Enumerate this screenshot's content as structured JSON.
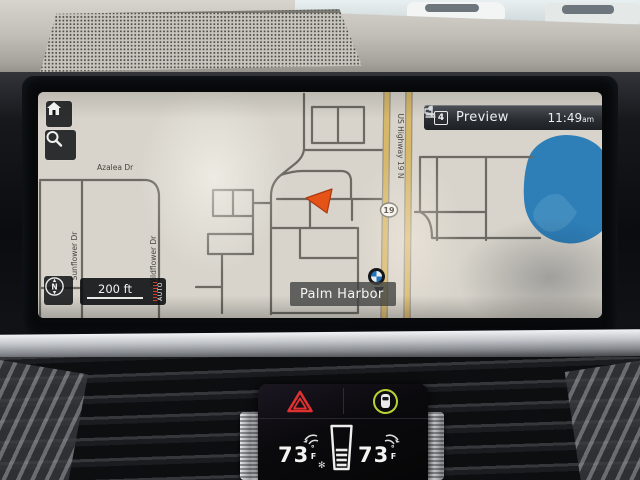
{
  "colors": {
    "map_bg": "#d8d4cb",
    "road": "#6c6a63",
    "highway": "#d7b869",
    "highway_casing": "#97948b",
    "water": "#2e7fb8",
    "arrow": "#e65317",
    "hazard": "#e03131",
    "green_ring": "#b9d335"
  },
  "status_bar": {
    "source_badge": "4",
    "source_label": "Preview",
    "time": "11:49",
    "meridiem": "am"
  },
  "map": {
    "streets": {
      "azalea": "Azalea Dr",
      "sunflower": "Sunflower Dr",
      "wildflower": "Wildflower Dr",
      "highway_name": "US Highway 19 N",
      "highway_shield": "19"
    },
    "poi_label": "Palm Harbor",
    "scale_text": "200 ft",
    "scale_mode": "AUTO",
    "compass_letter": "N"
  },
  "climate": {
    "driver_temp": "73",
    "passenger_temp": "73",
    "unit_degree": "°",
    "unit_letter": "F"
  }
}
